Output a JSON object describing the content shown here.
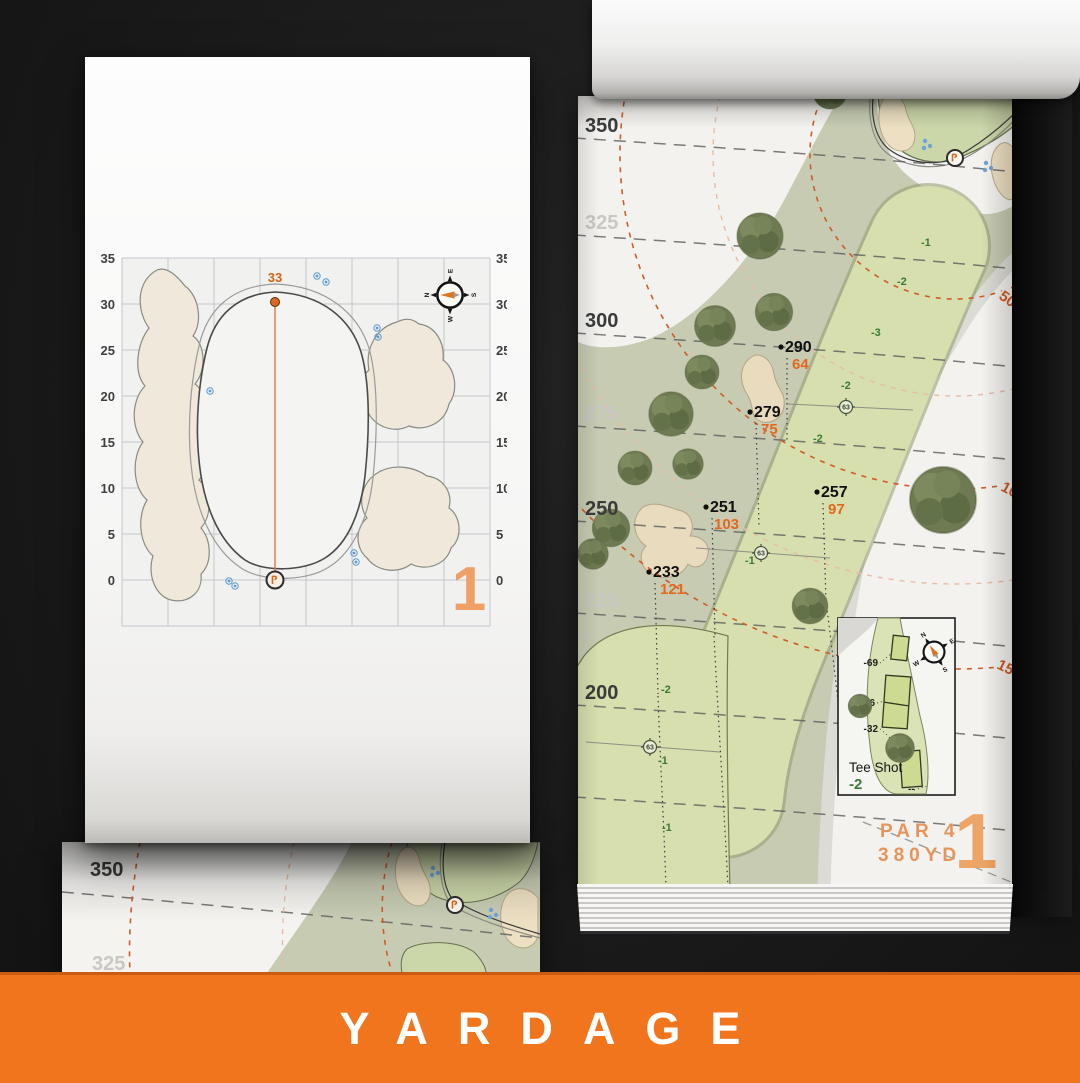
{
  "banner": {
    "title": "YARDAGE"
  },
  "palette": {
    "banner_orange": "#f0751c",
    "salmon_orange": "#eda467",
    "accent_orange": "#d96a1f",
    "green_text": "#3a7a36",
    "ink": "#3b3b3b"
  },
  "detail_page": {
    "hole_number": "1",
    "pin_distance": "33",
    "axis_labels": [
      "35",
      "30",
      "25",
      "20",
      "15",
      "10",
      "5",
      "0"
    ],
    "compass": {
      "n": "N",
      "e": "E",
      "s": "S",
      "w": "W"
    }
  },
  "under_page": {
    "major_label": "350",
    "minor_label": "325"
  },
  "map_page": {
    "hole_number": "1",
    "par_label": "PAR 4",
    "yardage_label": "380YD",
    "distance_labels": [
      "350",
      "325",
      "300",
      "275",
      "250",
      "225",
      "200"
    ],
    "arc_labels": [
      "50",
      "100",
      "150"
    ],
    "points": [
      {
        "primary": "290",
        "secondary": "64"
      },
      {
        "primary": "279",
        "secondary": "75"
      },
      {
        "primary": "257",
        "secondary": "97"
      },
      {
        "primary": "251",
        "secondary": "103"
      },
      {
        "primary": "233",
        "secondary": "121"
      }
    ],
    "sprinkler_labels": [
      "63",
      "63",
      "63"
    ],
    "elevation_labels": [
      "-1",
      "-2",
      "-3",
      "-2",
      "-2",
      "-1",
      "-2",
      "-1",
      "-1"
    ],
    "tee_inset": {
      "title": "Tee Shot",
      "elevation": "-2",
      "tee_markers": [
        "-69",
        "-46",
        "-32"
      ],
      "back_marker": "--"
    },
    "compass": {
      "n": "N",
      "e": "E",
      "s": "S",
      "w": "W"
    }
  }
}
